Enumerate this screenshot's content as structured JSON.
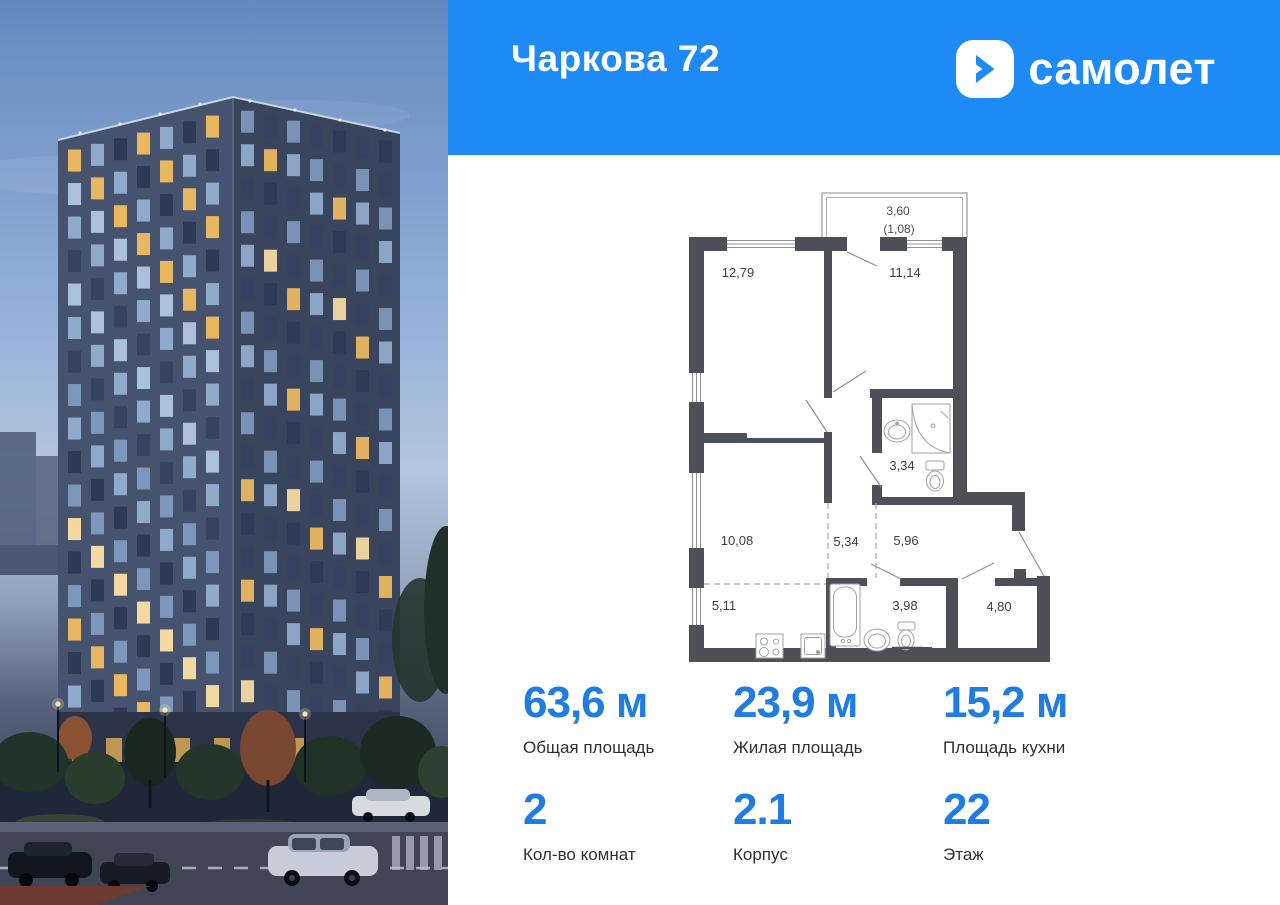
{
  "header": {
    "title": "Чаркова 72",
    "brand": "самолет"
  },
  "colors": {
    "header_blue": "#1E8AF5",
    "stat_blue": "#1E7CE2",
    "wall": "#4D5157"
  },
  "plan": {
    "balcony_area": "3,60",
    "balcony_reduced": "(1,08)",
    "rooms": {
      "bedroom1": "12,79",
      "bedroom2": "11,14",
      "bathroom": "3,34",
      "living": "10,08",
      "hall_left": "5,34",
      "hall_right": "5,96",
      "kitchen": "5,11",
      "bathroom2": "3,98",
      "entry": "4,80"
    }
  },
  "stats": {
    "items": [
      {
        "value": "63,6 м",
        "label": "Общая площадь"
      },
      {
        "value": "23,9 м",
        "label": "Жилая площадь"
      },
      {
        "value": "15,2 м",
        "label": "Площадь кухни"
      },
      {
        "value": "2",
        "label": "Кол-во комнат"
      },
      {
        "value": "2.1",
        "label": "Корпус"
      },
      {
        "value": "22",
        "label": "Этаж"
      }
    ]
  }
}
